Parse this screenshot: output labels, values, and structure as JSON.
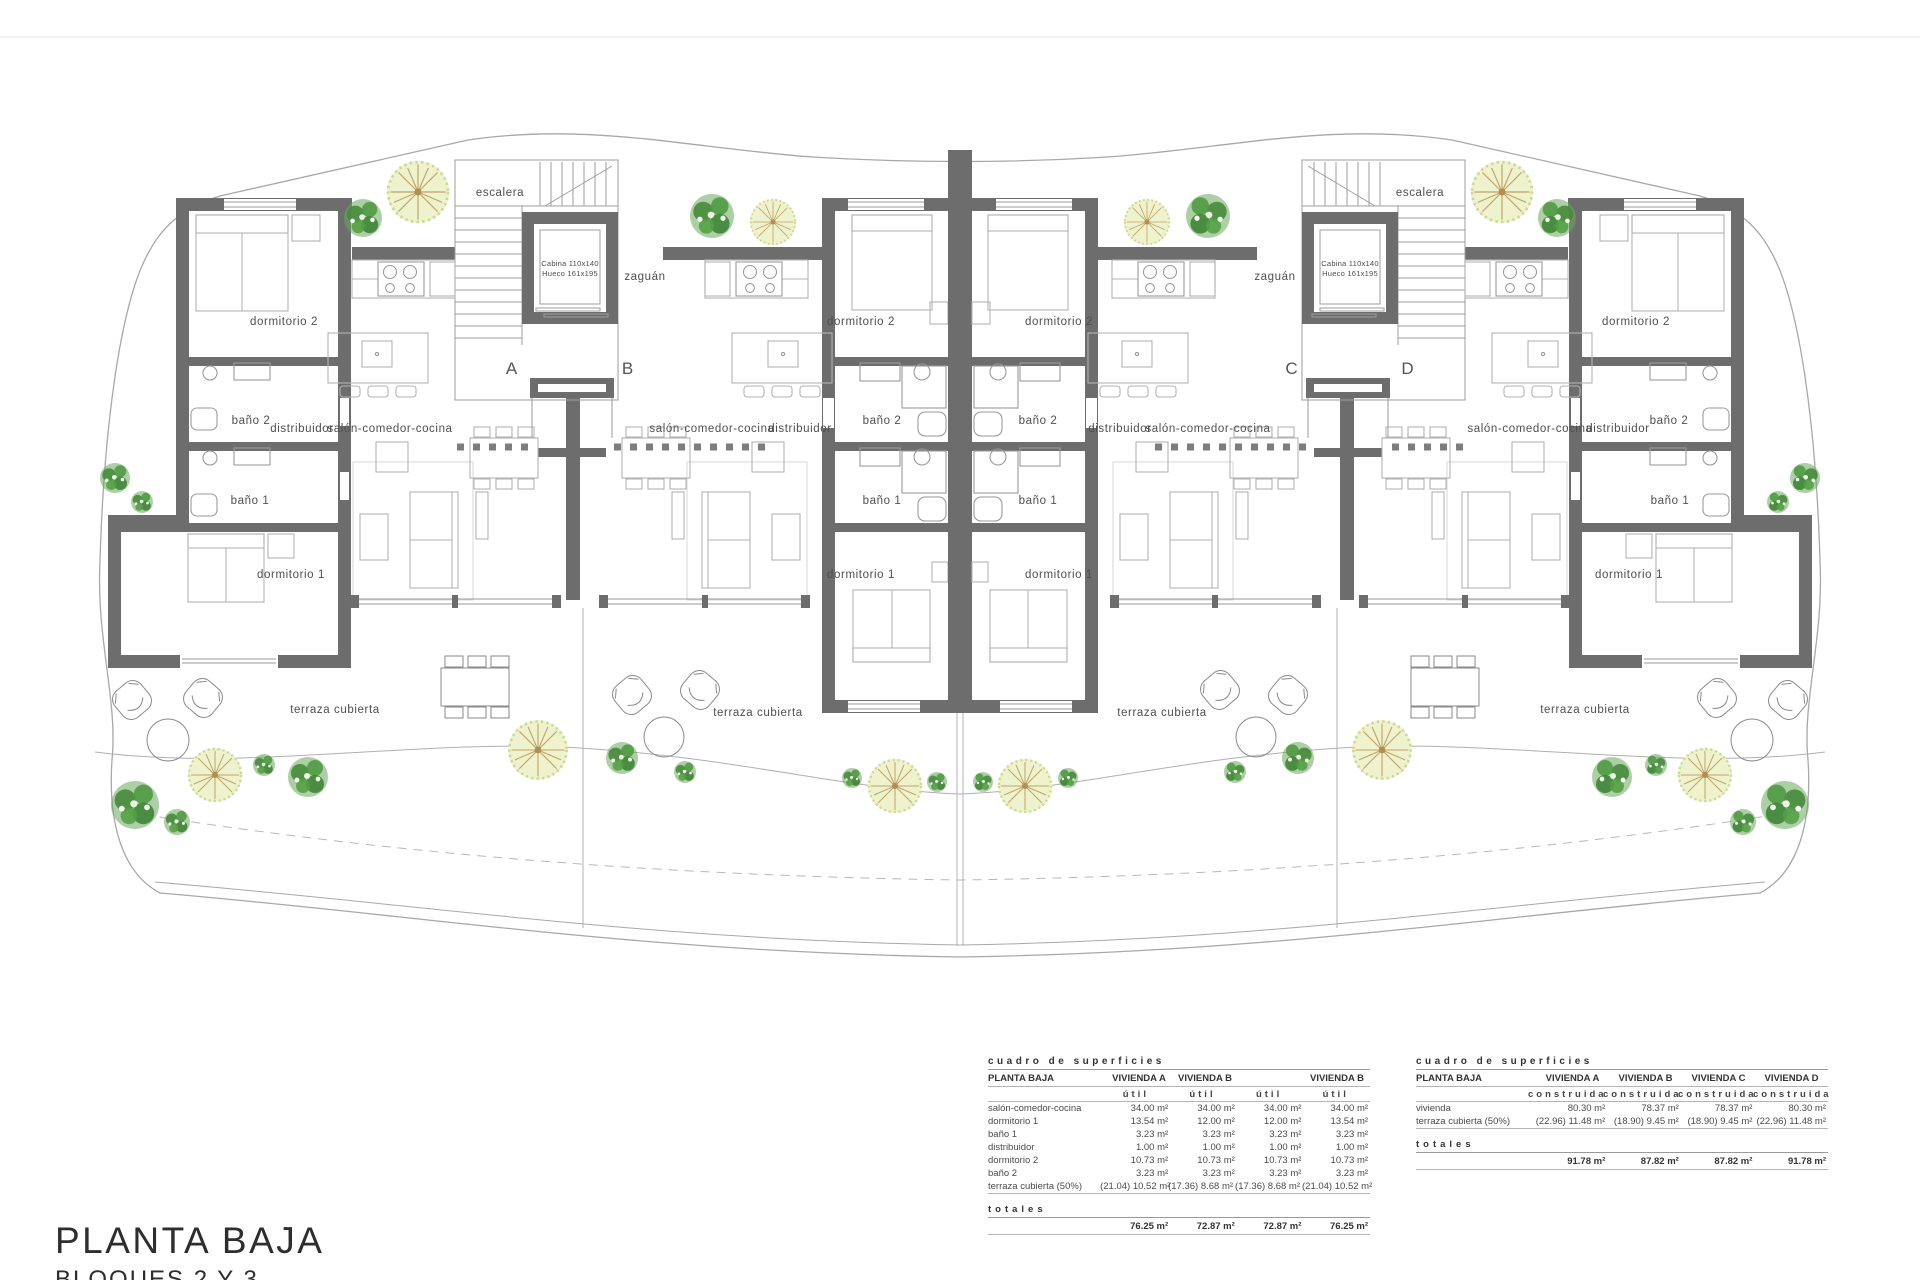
{
  "title_block": {
    "title": "PLANTA BAJA",
    "subtitle": "BLOQUES 2 Y 3"
  },
  "plan_labels": {
    "escalera": "escalera",
    "zaguan": "zaguán",
    "cabina_line1": "Cabina 110x140",
    "cabina_line2": "Hueco 161x195",
    "dormitorio1": "dormitorio 1",
    "dormitorio2": "dormitorio 2",
    "bano1": "baño 1",
    "bano2": "baño 2",
    "distribuidor": "distribuidor",
    "salon": "salón-comedor-cocina",
    "terraza": "terraza cubierta",
    "unit_a": "A",
    "unit_b": "B",
    "unit_c": "C",
    "unit_d": "D"
  },
  "surface_table_util": {
    "title": "cuadro de superficies",
    "row_header": "PLANTA BAJA",
    "col_headers": [
      "VIVIENDA A",
      "VIVIENDA B",
      "",
      "VIVIENDA B"
    ],
    "sub_header": "útil",
    "rows": [
      {
        "label": "salón-comedor-cocina",
        "values": [
          "34.00 m²",
          "34.00 m²",
          "34.00 m²",
          "34.00 m²"
        ]
      },
      {
        "label": "dormitorio 1",
        "values": [
          "13.54 m²",
          "12.00 m²",
          "12.00 m²",
          "13.54 m²"
        ]
      },
      {
        "label": "baño 1",
        "values": [
          "3.23 m²",
          "3.23 m²",
          "3.23 m²",
          "3.23 m²"
        ]
      },
      {
        "label": "distribuidor",
        "values": [
          "1.00 m²",
          "1.00 m²",
          "1.00 m²",
          "1.00 m²"
        ]
      },
      {
        "label": "dormitorio 2",
        "values": [
          "10.73 m²",
          "10.73 m²",
          "10.73 m²",
          "10.73 m²"
        ]
      },
      {
        "label": "baño 2",
        "values": [
          "3.23 m²",
          "3.23 m²",
          "3.23 m²",
          "3.23 m²"
        ]
      },
      {
        "label": "terraza cubierta (50%)",
        "values": [
          "(21.04) 10.52 m²",
          "(17.36) 8.68 m²",
          "(17.36) 8.68 m²",
          "(21.04) 10.52 m²"
        ]
      }
    ],
    "totals_label": "totales",
    "totals": [
      "76.25 m²",
      "72.87 m²",
      "72.87 m²",
      "76.25 m²"
    ]
  },
  "surface_table_construida": {
    "title": "cuadro de superficies",
    "row_header": "PLANTA BAJA",
    "col_headers": [
      "VIVIENDA A",
      "VIVIENDA B",
      "VIVIENDA C",
      "VIVIENDA D"
    ],
    "sub_header": "construida",
    "rows": [
      {
        "label": "vivienda",
        "values": [
          "80.30 m²",
          "78.37 m²",
          "78.37 m²",
          "80.30 m²"
        ]
      },
      {
        "label": "terraza cubierta (50%)",
        "values": [
          "(22.96) 11.48 m²",
          "(18.90) 9.45 m²",
          "(18.90) 9.45 m²",
          "(22.96) 11.48 m²"
        ]
      }
    ],
    "totals_label": "totales",
    "totals": [
      "91.78 m²",
      "87.82 m²",
      "87.82 m²",
      "91.78 m²"
    ]
  }
}
